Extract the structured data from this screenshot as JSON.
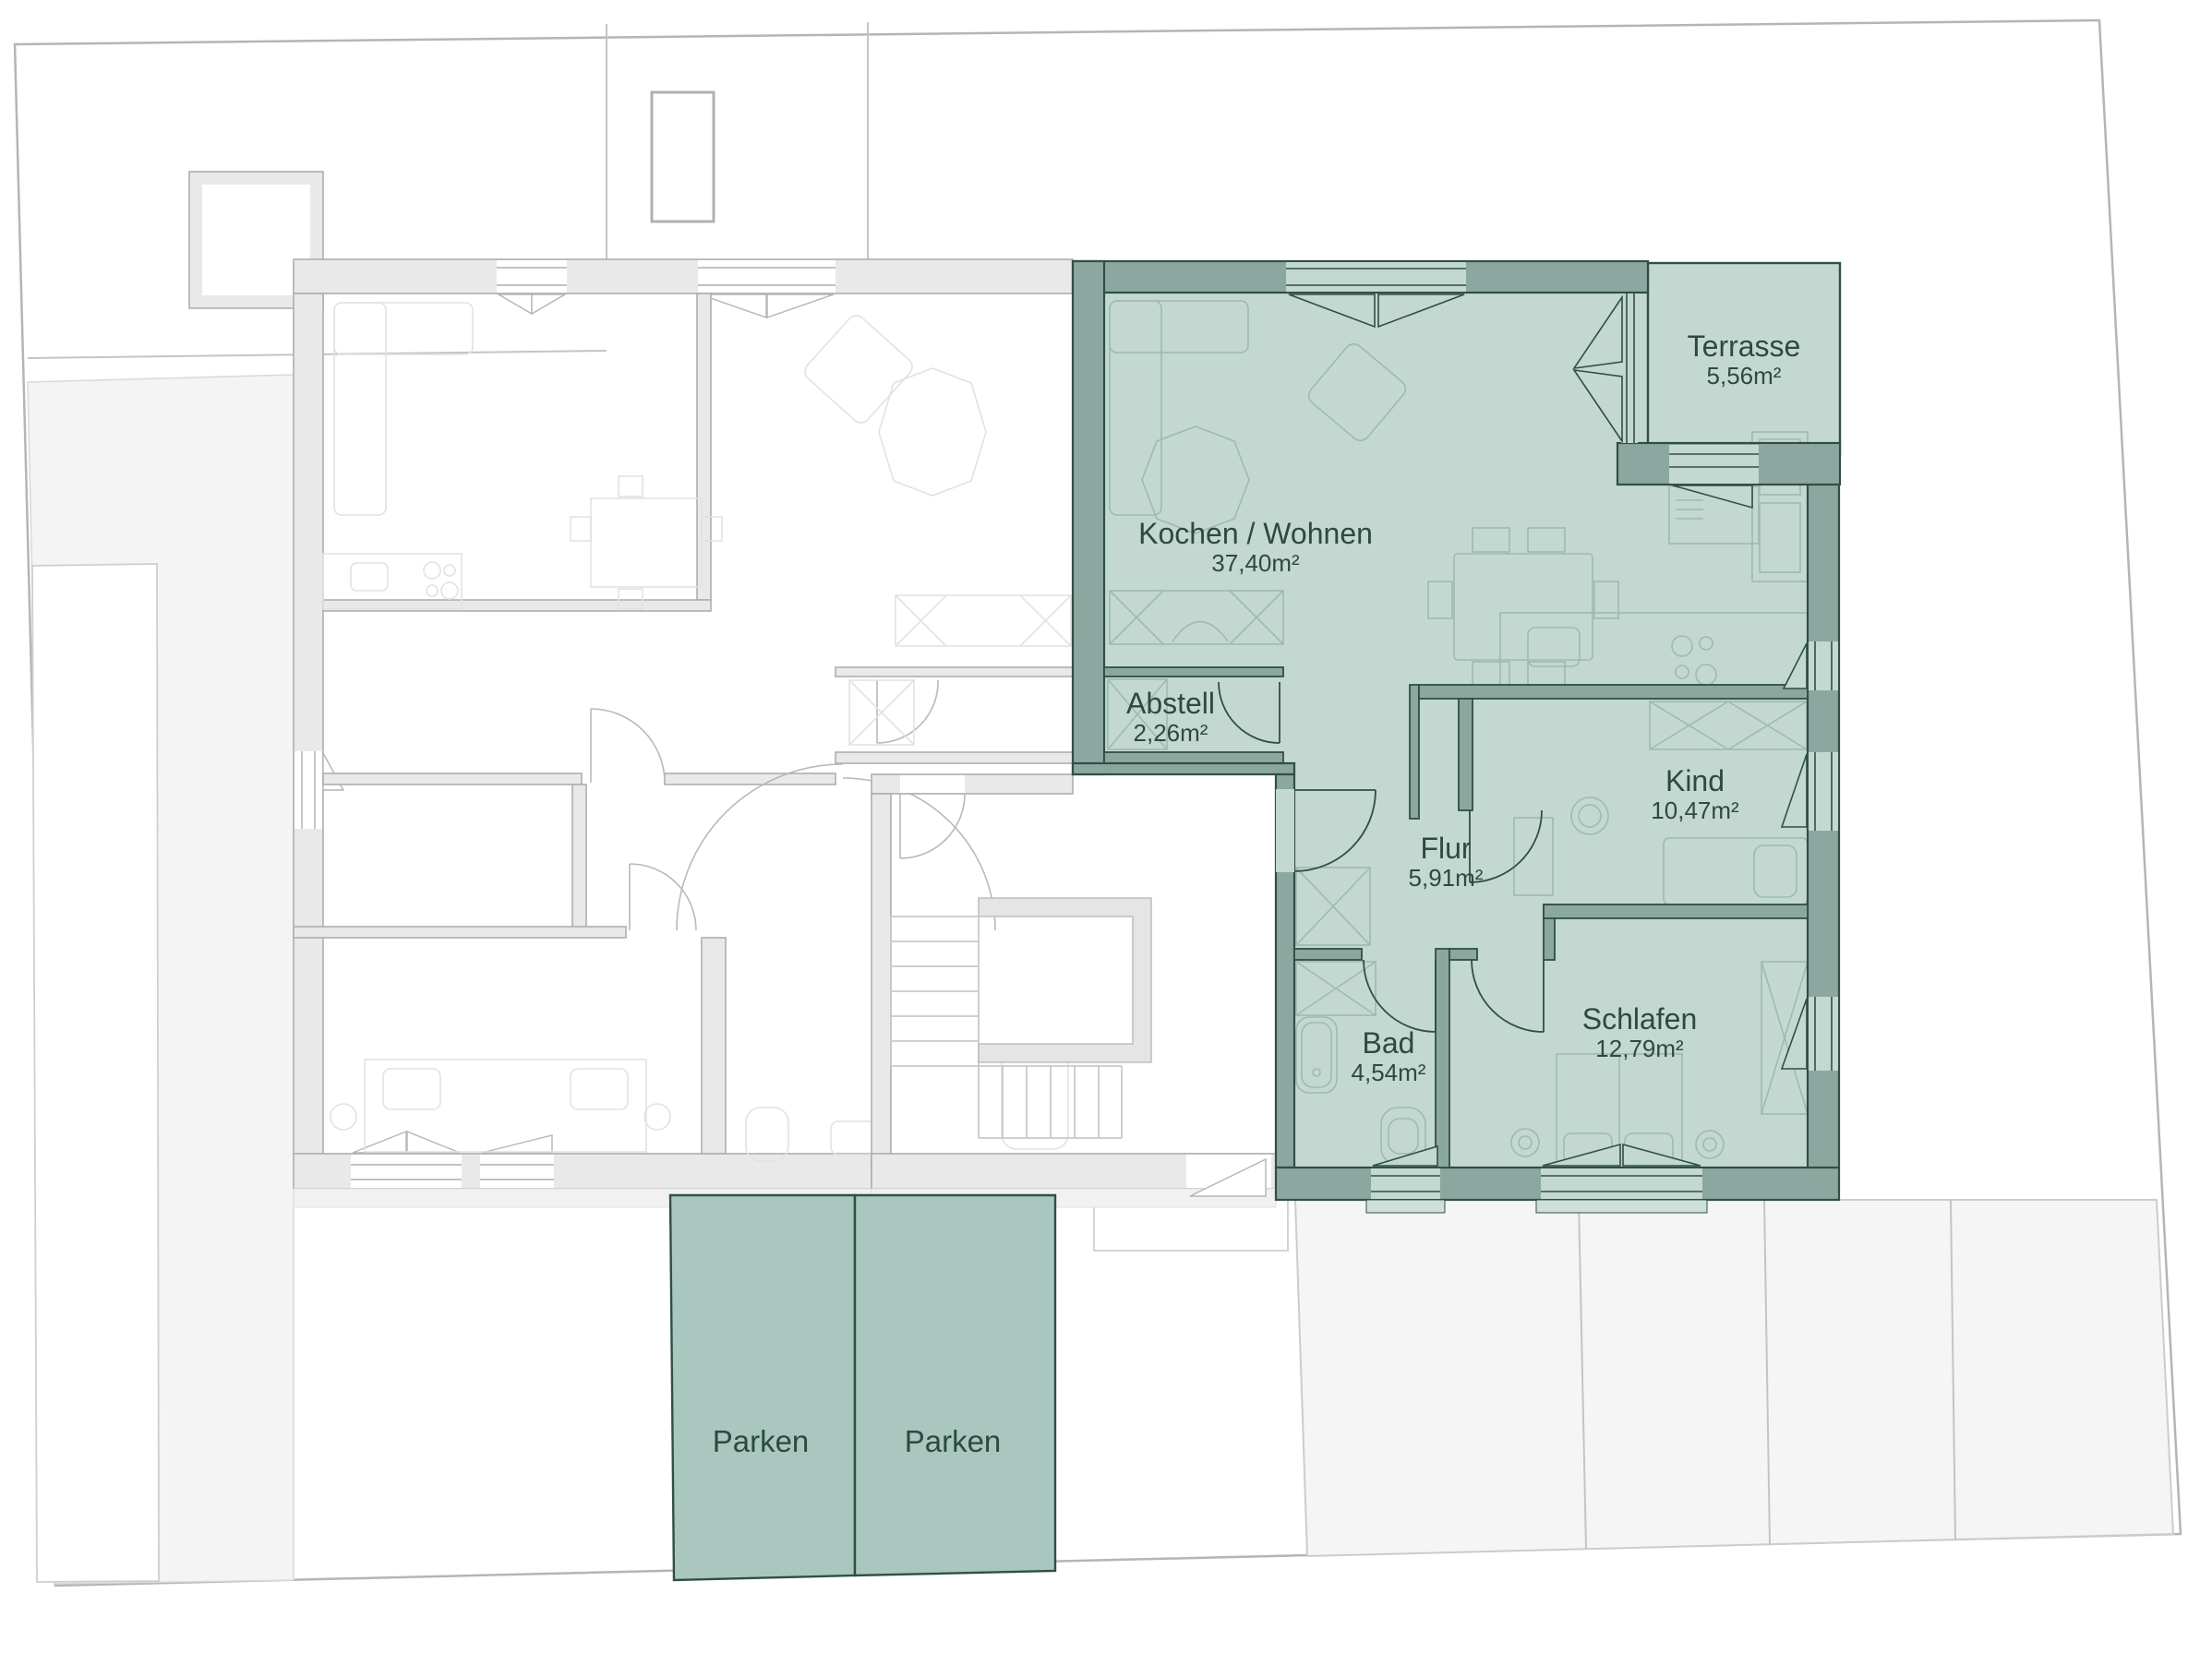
{
  "plan": {
    "type": "floor-plan",
    "highlighted_apartment": {
      "rooms": [
        {
          "name": "Kochen / Wohnen",
          "area": "37,40m²"
        },
        {
          "name": "Abstell",
          "area": "2,26m²"
        },
        {
          "name": "Terrasse",
          "area": "5,56m²"
        },
        {
          "name": "Flur",
          "area": "5,91m²"
        },
        {
          "name": "Kind",
          "area": "10,47m²"
        },
        {
          "name": "Bad",
          "area": "4,54m²"
        },
        {
          "name": "Schlafen",
          "area": "12,79m²"
        }
      ]
    },
    "parking": {
      "labels": [
        "Parken",
        "Parken"
      ]
    },
    "colors": {
      "highlight_wall": "#8ca79f",
      "highlight_floor": "#c3d8d1",
      "highlight_outline": "#2f4f45",
      "label_text": "#2c4a40",
      "parking_fill": "#a9c7bf",
      "muted_wall": "#e9e9e9",
      "site_gray": "#f4f4f4",
      "boundary_line": "#b5b5b5"
    }
  }
}
